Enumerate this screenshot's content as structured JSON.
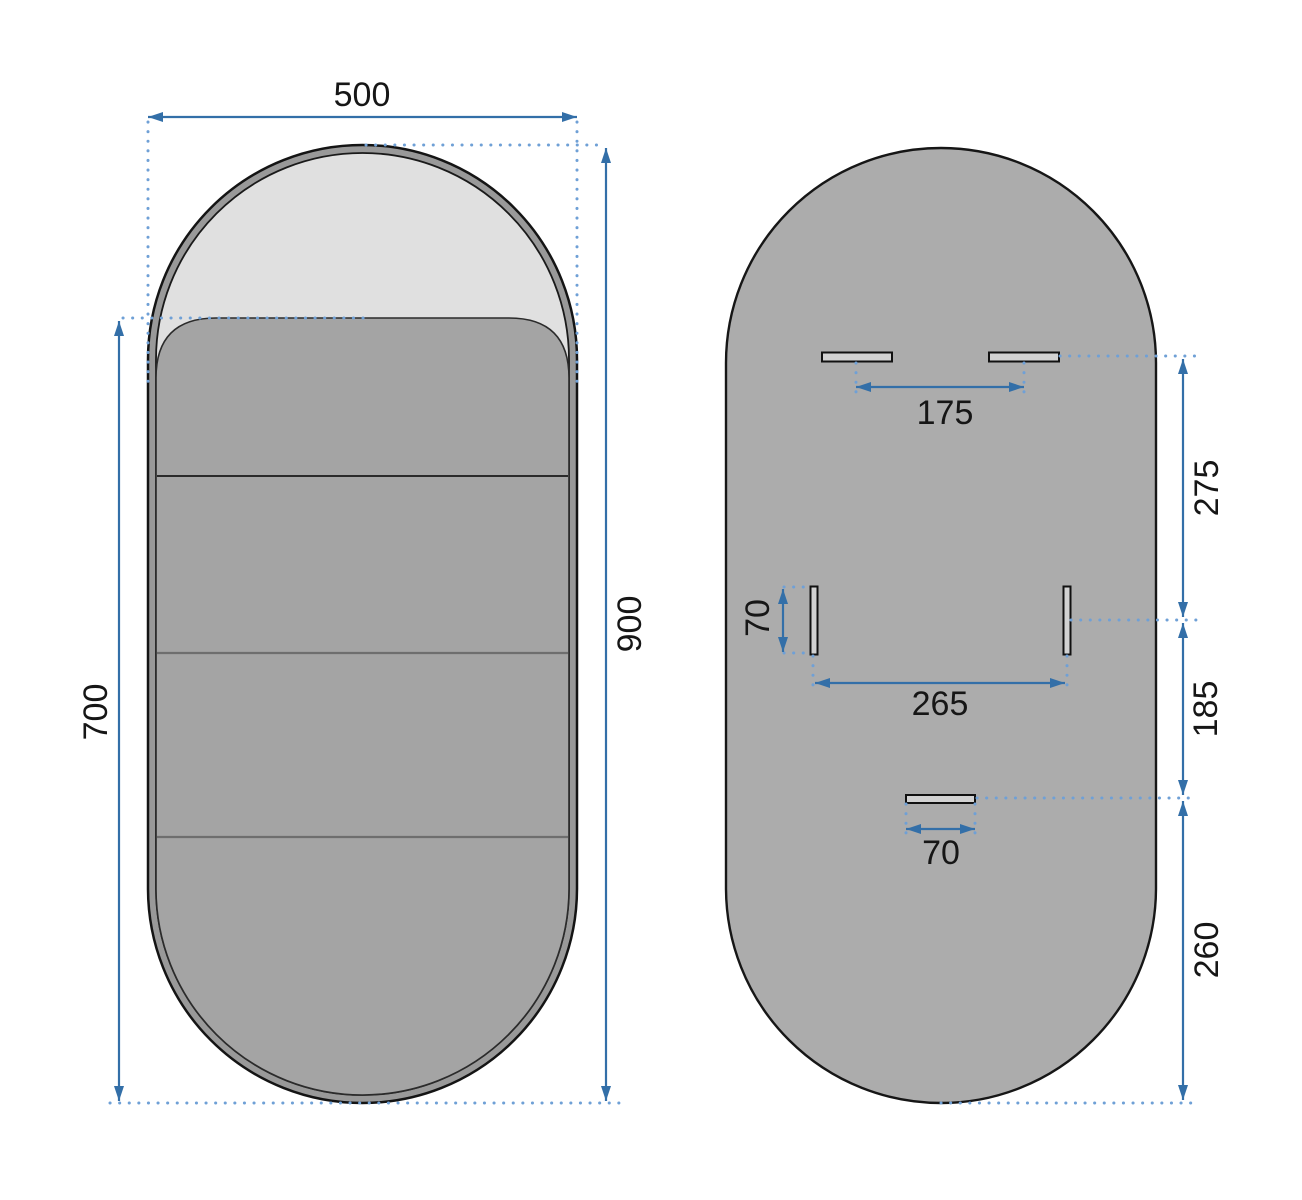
{
  "front_view": {
    "width_label": "500",
    "height_label": "900",
    "cover_height_label": "700"
  },
  "back_view": {
    "top_slots_spacing_label": "175",
    "top_slot_offset_label": "275",
    "side_slot_height_label": "70",
    "side_slots_spacing_label": "265",
    "side_to_bottom_offset_label": "185",
    "bottom_slot_width_label": "70",
    "bottom_edge_offset_label": "260"
  },
  "colors": {
    "dimension_line_color": "#336fa8",
    "extension_dot_color": "#6fa0d6",
    "mirror_rim_color": "#999999",
    "mirror_glass_color": "#e0e0e0",
    "mirror_cover_color": "#a4a4a4",
    "back_panel_color": "#acacac",
    "slot_fill_color": "#d2d2d2"
  }
}
